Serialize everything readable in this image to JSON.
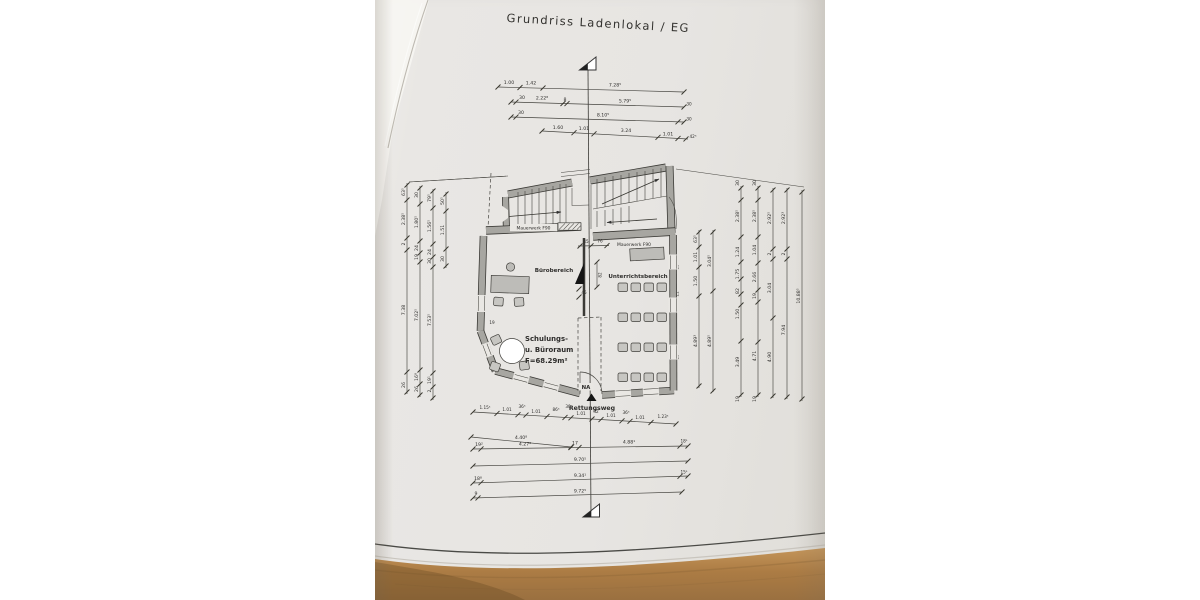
{
  "drawing": {
    "title": "Grundriss Ladenlokal / EG"
  },
  "plan": {
    "mauerwerk": "Mauerwerk F90",
    "buero": "Bürobereich",
    "unterricht": "Unterrichtsbereich",
    "room": [
      "Schulungs-",
      "u. Büroraum",
      "F=68.29m²"
    ],
    "na": "NA",
    "rettungsweg": "Rettungsweg"
  },
  "dims": {
    "top": {
      "r1": [
        "1.00",
        "1.42",
        "7.28⁵"
      ],
      "r2": [
        "30",
        "2.22⁸",
        "8",
        "5.79⁵",
        "30"
      ],
      "r3": [
        "30",
        "8.10⁵",
        "30"
      ],
      "r4": [
        "1.60",
        "1.01",
        "3.24",
        "1.01",
        "42⁵"
      ]
    },
    "bottom": {
      "r1": [
        "1.15⁵",
        "1.01",
        "36⁵",
        "1.01",
        "86⁵",
        "30",
        "1.01",
        "42",
        "1.01",
        "36⁵",
        "1.01",
        "1.23⁵"
      ],
      "r2": [
        "4.40⁸"
      ],
      "r3": [
        "19²",
        "4.27⁸",
        "17",
        "4.88¹",
        "18¹"
      ],
      "r4": [
        "9.70⁵"
      ],
      "r5": [
        "18⁸",
        "9.34¹",
        "15¹"
      ],
      "r6": [
        "9",
        "9.72⁵"
      ]
    },
    "left": {
      "c1": [
        "63⁵",
        "2.38⁵",
        "2",
        "7.38",
        "26"
      ],
      "c2": [
        "30",
        "1.80⁵",
        "24",
        "19",
        "7.02⁵",
        "16⁸",
        "26"
      ],
      "c3": [
        "79⁵",
        "1.56⁵",
        "24",
        "30",
        "7.53⁵",
        "19¹",
        "2"
      ],
      "c4": [
        "50⁵",
        "1.51",
        "30"
      ]
    },
    "right": {
      "a": [
        "63⁵",
        "1.01",
        "1.50",
        "4.89³"
      ],
      "b": [
        "3.04⁵",
        "4.89⁵"
      ],
      "c": [
        "30",
        "2.38⁵",
        "1.24",
        "1.75",
        "82",
        "1.50",
        "3.49",
        "19"
      ],
      "d": [
        "30",
        "2.38⁵",
        "1.04",
        "2.66",
        "19",
        "4.71",
        "19"
      ],
      "e": [
        "2.92⁵",
        "2",
        "3.04",
        "4.90"
      ],
      "f": [
        "2.92³",
        "2",
        "7.94"
      ],
      "g": [
        "10.88⁵"
      ],
      "wall": [
        "19",
        "11",
        "19"
      ]
    },
    "inner": [
      "45",
      "76",
      "82",
      "45",
      "19"
    ]
  },
  "colors": {
    "paper": "#e9e7e3",
    "wood": "#b08046",
    "wall_fill": "#a7a6a1",
    "ink": "#3b3a36"
  }
}
